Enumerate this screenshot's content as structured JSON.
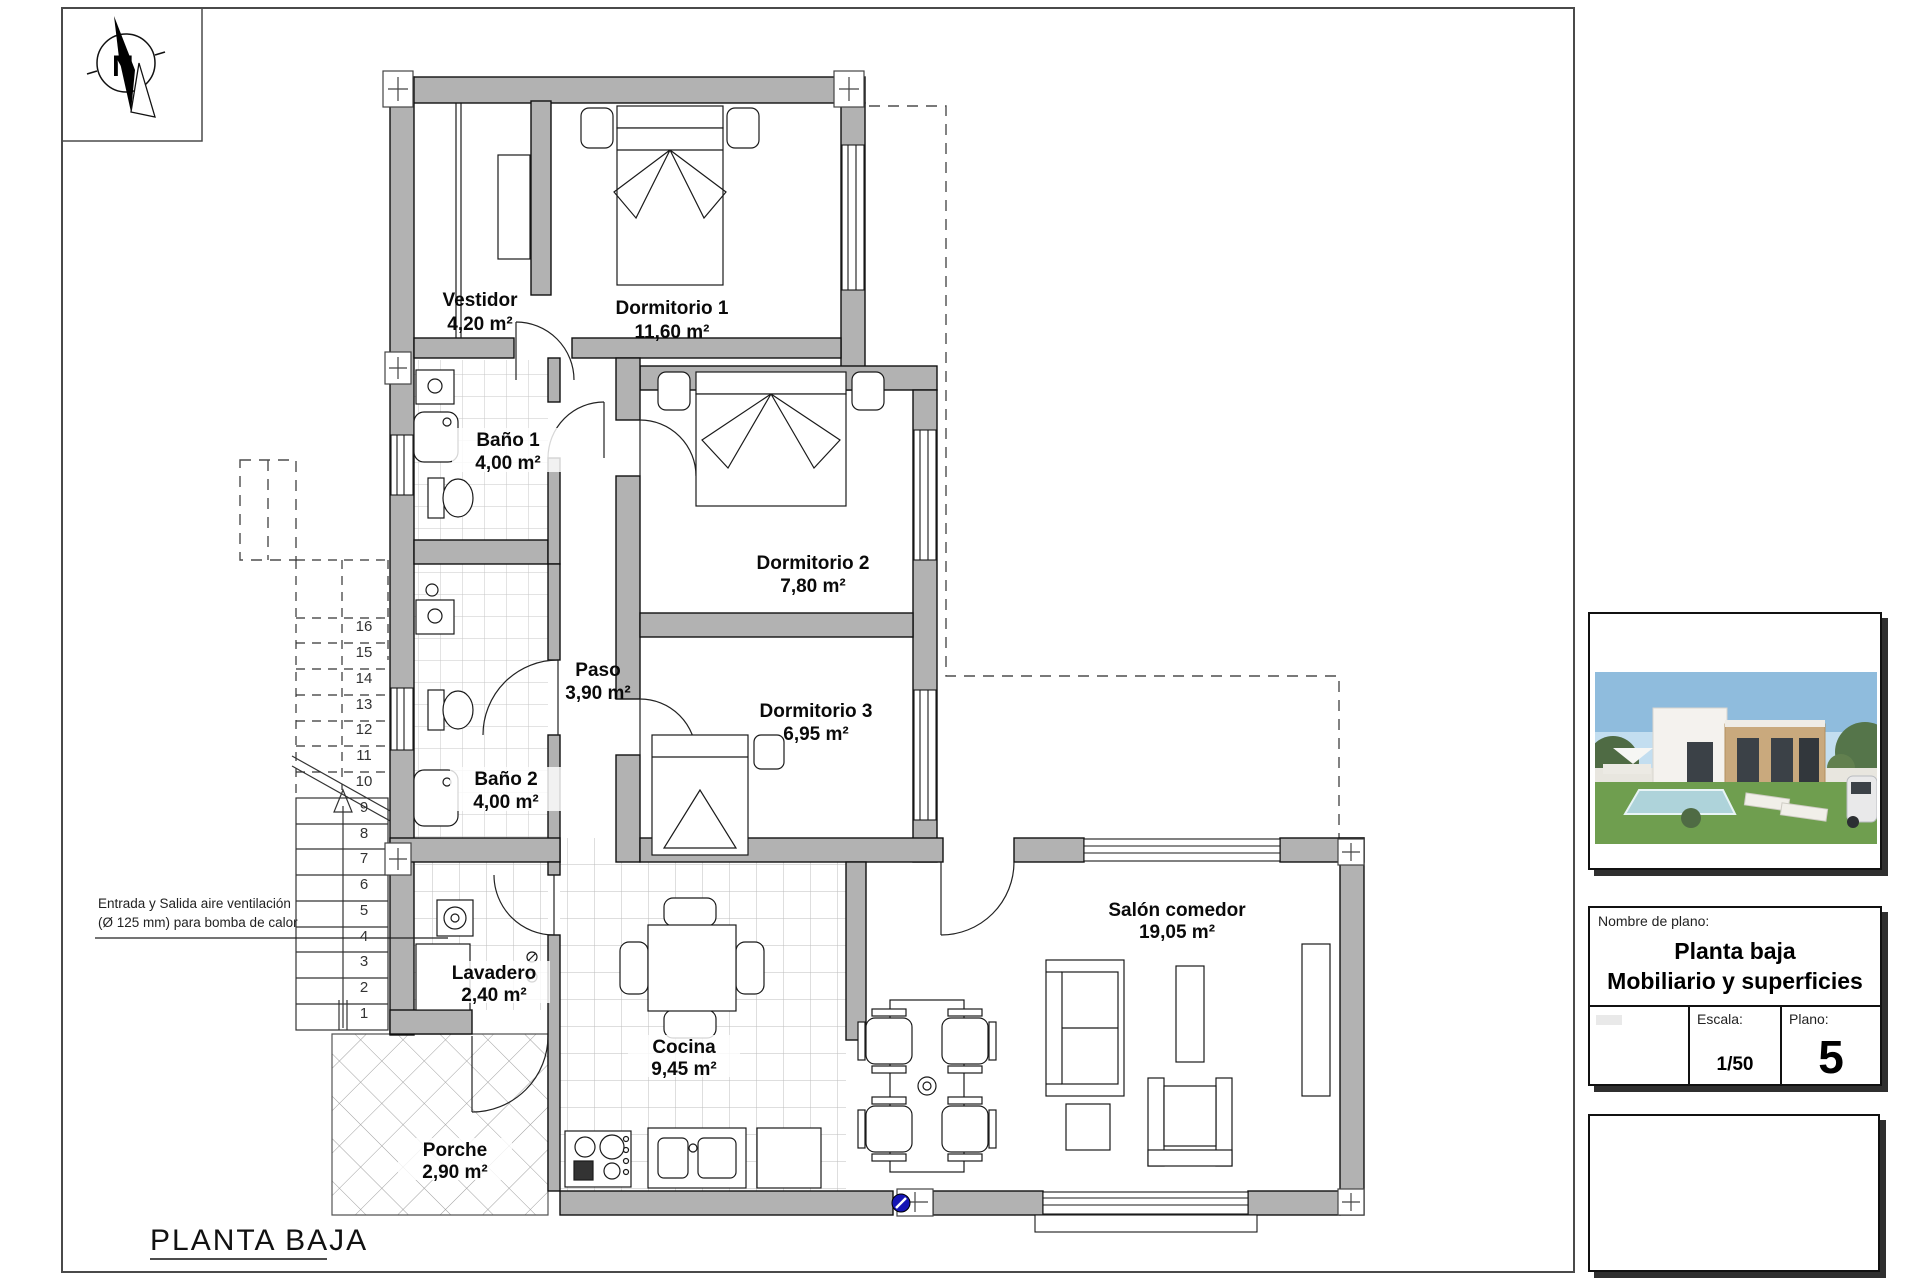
{
  "sheet": {
    "plan_title": "PLANTA BAJA"
  },
  "compass": {
    "north_label": "N"
  },
  "annotation": {
    "line1": "Entrada y Salida aire ventilación",
    "line2": "(Ø 125 mm) para bomba de calor"
  },
  "rooms": [
    {
      "name": "Vestidor",
      "area": "4,20 m²"
    },
    {
      "name": "Dormitorio 1",
      "area": "11,60 m²"
    },
    {
      "name": "Baño 1",
      "area": "4,00 m²"
    },
    {
      "name": "Dormitorio 2",
      "area": "7,80 m²"
    },
    {
      "name": "Paso",
      "area": "3,90 m²"
    },
    {
      "name": "Dormitorio 3",
      "area": "6,95 m²"
    },
    {
      "name": "Baño 2",
      "area": "4,00 m²"
    },
    {
      "name": "Lavadero",
      "area": "2,40 m²"
    },
    {
      "name": "Cocina",
      "area": "9,45 m²"
    },
    {
      "name": "Porche",
      "area": "2,90 m²"
    },
    {
      "name": "Salón comedor",
      "area": "19,05 m²"
    }
  ],
  "stairs": {
    "steps": [
      "1",
      "2",
      "3",
      "4",
      "5",
      "6",
      "7",
      "8",
      "9",
      "10",
      "11",
      "12",
      "13",
      "14",
      "15",
      "16"
    ]
  },
  "title_block": {
    "header_label": "Nombre de plano:",
    "name_line1": "Planta baja",
    "name_line2": "Mobiliario y superficies",
    "escala_label": "Escala:",
    "escala_value": "1/50",
    "plano_label": "Plano:",
    "plano_value": "5"
  },
  "colors": {
    "wall_gray": "#b2b2b2",
    "vent_blue": "#1515b5"
  }
}
